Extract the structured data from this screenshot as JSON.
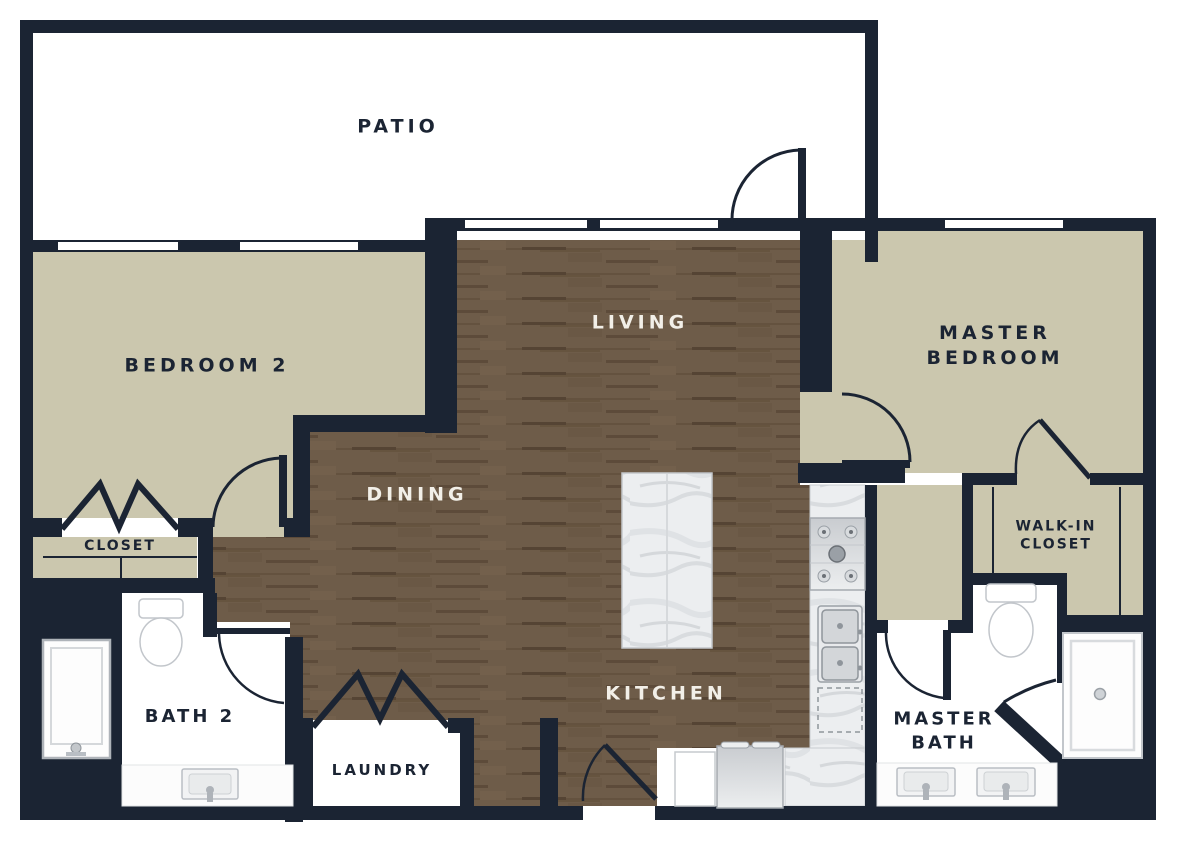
{
  "figure_type": "apartment-floor-plan",
  "colors": {
    "wall": "#1b2433",
    "room_beige": "#cbc7ae",
    "wood_floor": "#6e5c49",
    "wood_floor_dark": "#5d4c3b",
    "white_room": "#ffffff",
    "marble_counter": "#ebedef",
    "fixture_outline": "#b9bec4",
    "label_dark": "#1b2433",
    "label_light": "#f2efe8"
  },
  "rooms": {
    "patio": {
      "label": "PATIO"
    },
    "bedroom_2": {
      "label": "BEDROOM 2"
    },
    "living": {
      "label": "LIVING"
    },
    "master_bedroom": {
      "label_line1": "MASTER",
      "label_line2": "BEDROOM"
    },
    "dining": {
      "label": "DINING"
    },
    "kitchen": {
      "label": "KITCHEN"
    },
    "closet": {
      "label": "CLOSET"
    },
    "bath_2": {
      "label": "BATH 2"
    },
    "laundry": {
      "label": "LAUNDRY"
    },
    "walk_in_closet": {
      "label_line1": "WALK-IN",
      "label_line2": "CLOSET"
    },
    "master_bath": {
      "label_line1": "MASTER",
      "label_line2": "BATH"
    }
  },
  "fixtures": [
    "kitchen-island",
    "cooktop",
    "double-sink",
    "dishwasher",
    "range-oven",
    "refrigerator",
    "toilet-bath2",
    "shower-bath2",
    "vanity-sink-bath2",
    "toilet-master",
    "shower-master",
    "vanity-double-sink-master",
    "bifold-closet-doors",
    "bifold-laundry-doors"
  ],
  "windows_count": 5,
  "doors_count": 8
}
